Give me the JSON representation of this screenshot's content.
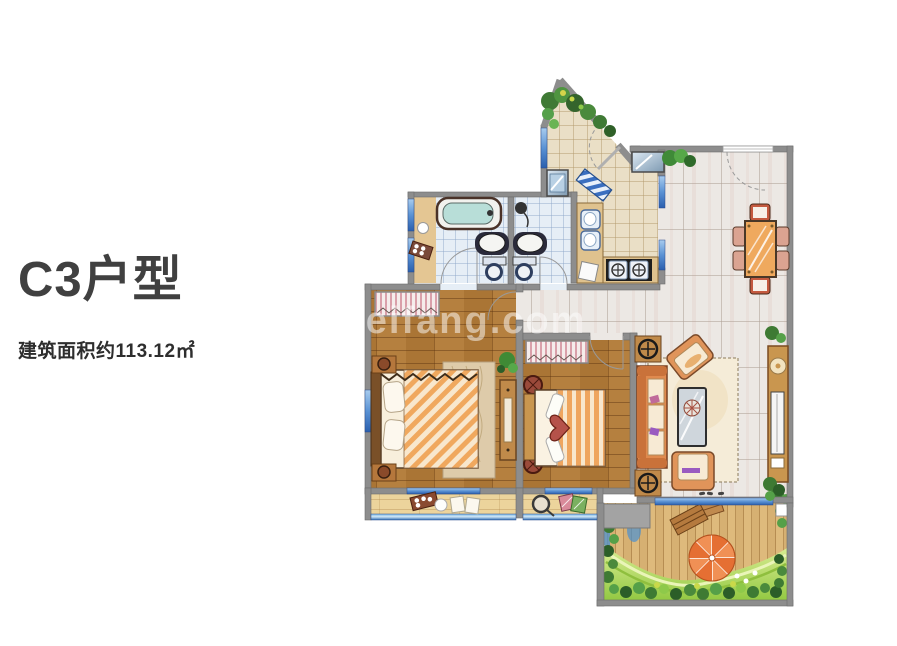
{
  "page": {
    "background": "#ffffff"
  },
  "info_panel": {
    "title": "C3户型",
    "area_label": "建筑面积约113.12㎡",
    "title_color": "#404040",
    "label_color": "#2e2e2e"
  },
  "watermark": {
    "text": "meifang.com",
    "color": "#ffffff",
    "opacity": 0.5
  },
  "floor_plan": {
    "palette": {
      "wall_gray": "#8d8d8d",
      "bedroom_wood": "#b5803f",
      "living_tile": "#ece8e4",
      "foyer_tile": "#eadfc6",
      "bath_tile": "#e6eef6",
      "balcony_wood": "#ecd49c",
      "deck_wood": "#deba7c",
      "window_blue": "#3a6fc0",
      "railing_blue": "#2e6db4",
      "lawn_green": "#9ccf4a",
      "bush_green": "#3e7a33",
      "water_blue": "#3f87c9",
      "sofa_orange": "#e08a4e",
      "accent_red": "#b5524a",
      "umbrella_orange": "#e56f33",
      "table_wood": "#efa95e"
    }
  }
}
